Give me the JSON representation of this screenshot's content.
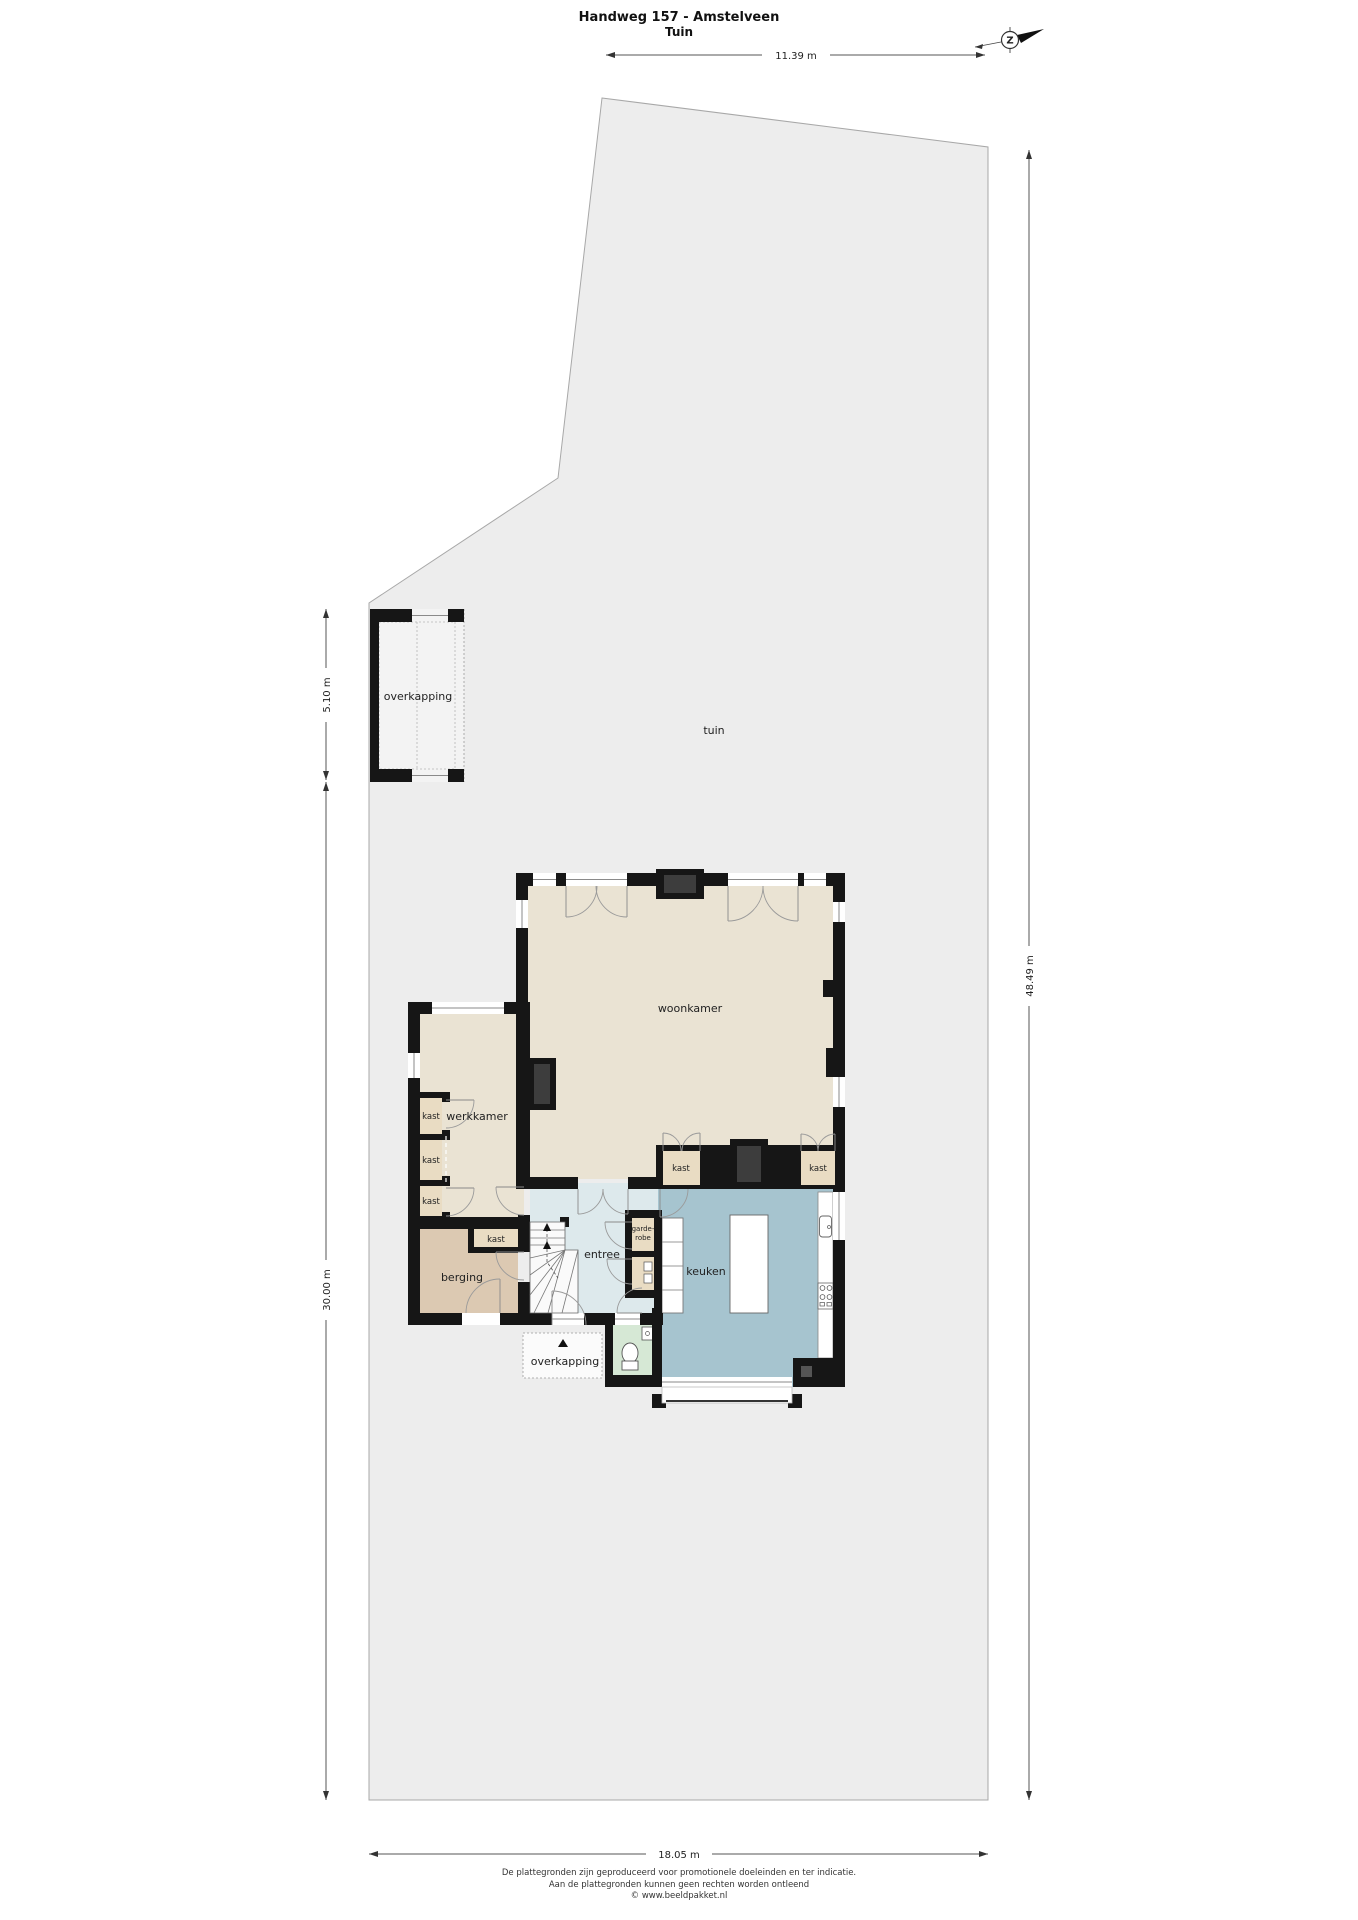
{
  "header": {
    "title": "Handweg 157 - Amstelveen",
    "subtitle": "Tuin"
  },
  "compass": {
    "letter": "Z"
  },
  "dimensions": {
    "top": "11.39 m",
    "overkapping": "5.10 m",
    "garden_left": "30.00 m",
    "garden_right": "48.49 m",
    "garden_bottom": "18.05 m"
  },
  "rooms": {
    "tuin": "tuin",
    "overkapping": "overkapping",
    "woonkamer": "woonkamer",
    "werkkamer": "werkkamer",
    "kast": "kast",
    "berging": "berging",
    "entree": "entree",
    "garderobe1": "garde-",
    "garderobe2": "robe",
    "keuken": "keuken"
  },
  "footer": {
    "line1": "De plattegronden zijn geproduceerd voor promotionele doeleinden en ter indicatie.",
    "line2": "Aan de plattegronden kunnen geen rechten worden ontleend",
    "line3": "© www.beeldpakket.nl"
  },
  "colors": {
    "garden": "#ededed",
    "wall": "#161616",
    "floor_living": "#eae3d3",
    "floor_storage": "#dcc9b2",
    "floor_closet": "#e9dcc3",
    "floor_entry": "#dde9ec",
    "floor_kitchen": "#a6c4cf",
    "floor_toilet": "#d6e8d5"
  }
}
